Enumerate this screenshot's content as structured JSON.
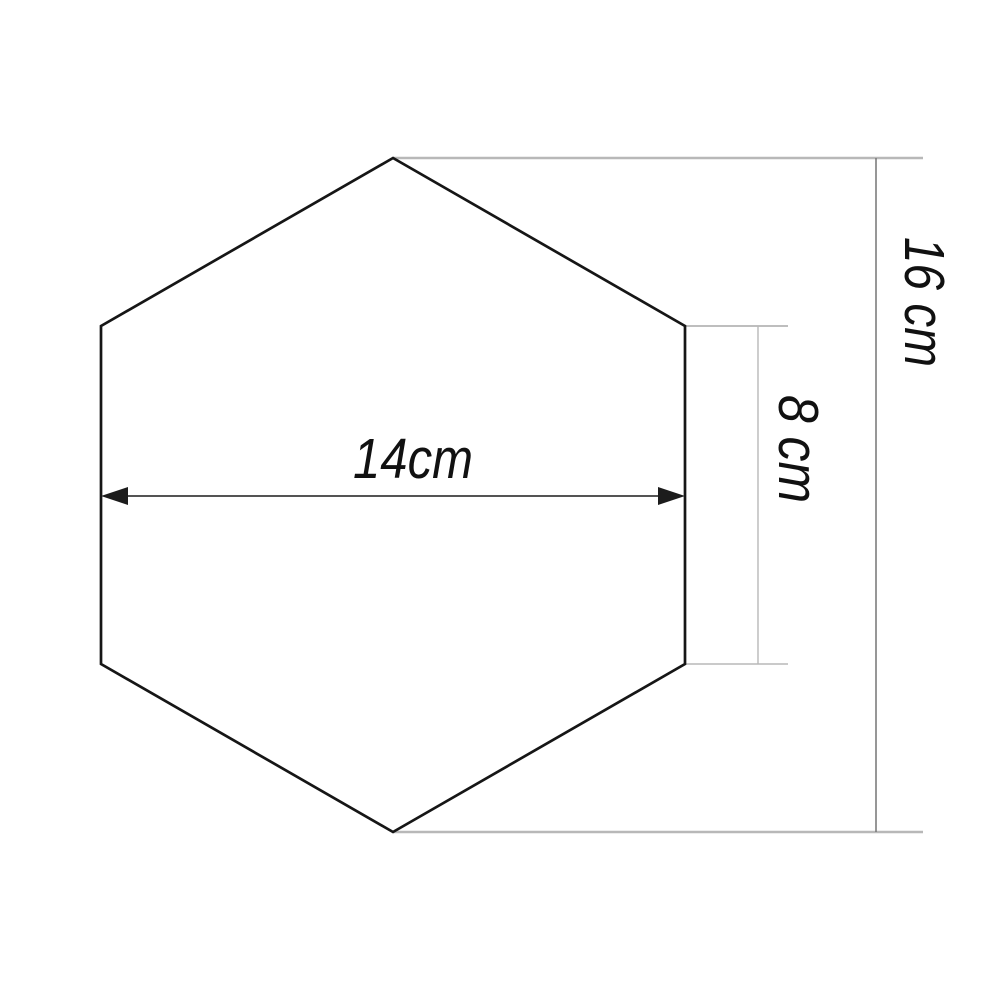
{
  "figure": {
    "shape": "hexagon",
    "labels": {
      "width": "14cm",
      "side": "8 cm",
      "height": "16 cm"
    }
  },
  "colors": {
    "shape_outline": "#161616",
    "arrow": "#1c1c1c",
    "witness_light": "#b8b8b8",
    "witness_mid": "#a9a9a9",
    "dimension_rule": "#757575",
    "label_text": "#111111"
  }
}
